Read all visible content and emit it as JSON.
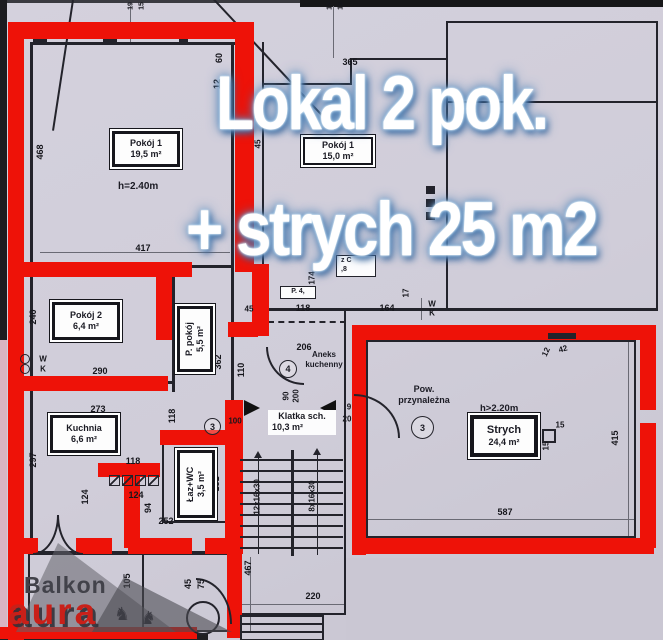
{
  "overlay": {
    "line1": "Lokal 2 pok.",
    "line2": "+ strych 25 m2",
    "text_color": "#ffffff",
    "glow_color": "#3f74ac"
  },
  "watermark": {
    "line1": "Balkon",
    "line2": "aura",
    "goat_icon": "♞",
    "red": "#c92019"
  },
  "colors": {
    "outline_red": "#ee1208",
    "paper": "#d0cdd9",
    "ink": "#23232b"
  },
  "rooms": {
    "pokoj1_left": {
      "name": "Pokój 1",
      "area": "19,5  m²",
      "height": "h=2.40m"
    },
    "pokoj2": {
      "name": "Pokój 2",
      "area": "6,4   m²"
    },
    "p_pokoj": {
      "name": "P. pokój",
      "area": "5,5  m²"
    },
    "kuchnia": {
      "name": "Kuchnia",
      "area": "6,6   m²"
    },
    "laz_wc": {
      "name": "Łaz+WC",
      "area": "3,5  m²"
    },
    "klatka": {
      "name": "Klatka sch.",
      "area": "10,3  m²"
    },
    "aneks": {
      "line1": "Aneks",
      "line2": "kuchenny",
      "circle": "4"
    },
    "pokoj1_right": {
      "name": "Pokój 1",
      "area": "15,0  m²"
    },
    "pow_przynalezna": {
      "line1": "Pow.",
      "line2": "przynależna",
      "circle": "3"
    },
    "strych": {
      "name": "Strych",
      "area": "24,4  m²",
      "height": "h>2.20m"
    },
    "hall_circle": "3",
    "partial_label_1": {
      "line1": "z   C",
      "line2": ",8"
    },
    "partial_label_2": {
      "line1": "P.  4,"
    }
  },
  "dimensions": {
    "labels": [
      {
        "t": "19",
        "x": 131,
        "y": 6,
        "r": -90,
        "fs": 7
      },
      {
        "t": "15",
        "x": 142,
        "y": 6,
        "r": -90,
        "fs": 7
      },
      {
        "t": "19",
        "x": 330,
        "y": 6,
        "r": -90,
        "fs": 7
      },
      {
        "t": "15",
        "x": 341,
        "y": 6,
        "r": -90,
        "fs": 7
      },
      {
        "t": "60",
        "x": 219,
        "y": 58,
        "r": -90
      },
      {
        "t": "12",
        "x": 217,
        "y": 84,
        "r": -90
      },
      {
        "t": "365",
        "x": 350,
        "y": 62
      },
      {
        "t": "45",
        "x": 258,
        "y": 144,
        "r": -90,
        "fs": 8
      },
      {
        "t": "468",
        "x": 40,
        "y": 152,
        "r": -90
      },
      {
        "t": "417",
        "x": 143,
        "y": 248
      },
      {
        "t": "240",
        "x": 33,
        "y": 317,
        "r": -90
      },
      {
        "t": "290",
        "x": 100,
        "y": 371
      },
      {
        "t": "273",
        "x": 98,
        "y": 409
      },
      {
        "t": "297",
        "x": 33,
        "y": 460,
        "r": -90
      },
      {
        "t": "118",
        "x": 172,
        "y": 416,
        "r": -90
      },
      {
        "t": "362",
        "x": 218,
        "y": 362,
        "r": -90
      },
      {
        "t": "110",
        "x": 241,
        "y": 370,
        "r": -90
      },
      {
        "t": "206",
        "x": 304,
        "y": 347
      },
      {
        "t": "90",
        "x": 286,
        "y": 396,
        "r": -90,
        "fs": 8
      },
      {
        "t": "200",
        "x": 296,
        "y": 396,
        "r": -90,
        "fs": 8
      },
      {
        "t": "100",
        "x": 235,
        "y": 421,
        "fs": 8
      },
      {
        "t": "45",
        "x": 249,
        "y": 309,
        "fs": 8
      },
      {
        "t": "118",
        "x": 303,
        "y": 308
      },
      {
        "t": "164",
        "x": 387,
        "y": 308
      },
      {
        "t": "174",
        "x": 312,
        "y": 278,
        "r": -90,
        "fs": 8
      },
      {
        "t": "17",
        "x": 406,
        "y": 293,
        "r": -90,
        "fs": 8
      },
      {
        "t": "9",
        "x": 349,
        "y": 407,
        "fs": 8
      },
      {
        "t": "20",
        "x": 347,
        "y": 419,
        "fs": 8
      },
      {
        "t": "118",
        "x": 133,
        "y": 461
      },
      {
        "t": "124",
        "x": 136,
        "y": 495
      },
      {
        "t": "124",
        "x": 85,
        "y": 497,
        "r": -90
      },
      {
        "t": "94",
        "x": 148,
        "y": 508,
        "r": -90
      },
      {
        "t": "252",
        "x": 166,
        "y": 521
      },
      {
        "t": "181",
        "x": 216,
        "y": 484,
        "r": -90
      },
      {
        "t": "45",
        "x": 188,
        "y": 584,
        "r": -90
      },
      {
        "t": "75",
        "x": 201,
        "y": 584,
        "r": -90
      },
      {
        "t": "105",
        "x": 127,
        "y": 581,
        "r": -90
      },
      {
        "t": "467",
        "x": 248,
        "y": 568,
        "r": -90
      },
      {
        "t": "220",
        "x": 313,
        "y": 596
      },
      {
        "t": "12x16x30",
        "x": 257,
        "y": 497,
        "r": -90,
        "fs": 8
      },
      {
        "t": "8x16x30",
        "x": 312,
        "y": 496,
        "r": -90,
        "fs": 8
      },
      {
        "t": "12",
        "x": 546,
        "y": 352,
        "r": -65,
        "fs": 8
      },
      {
        "t": "42",
        "x": 563,
        "y": 349,
        "r": -15,
        "fs": 8
      },
      {
        "t": "15",
        "x": 560,
        "y": 425,
        "fs": 8
      },
      {
        "t": "15",
        "x": 546,
        "y": 446,
        "r": -90,
        "fs": 8
      },
      {
        "t": "587",
        "x": 505,
        "y": 512
      },
      {
        "t": "415",
        "x": 615,
        "y": 438,
        "r": -90
      },
      {
        "t": "W",
        "x": 43,
        "y": 359,
        "fs": 8
      },
      {
        "t": "K",
        "x": 43,
        "y": 369,
        "fs": 8
      },
      {
        "t": "W",
        "x": 432,
        "y": 304,
        "fs": 8
      },
      {
        "t": "K",
        "x": 432,
        "y": 313,
        "fs": 8
      }
    ]
  }
}
